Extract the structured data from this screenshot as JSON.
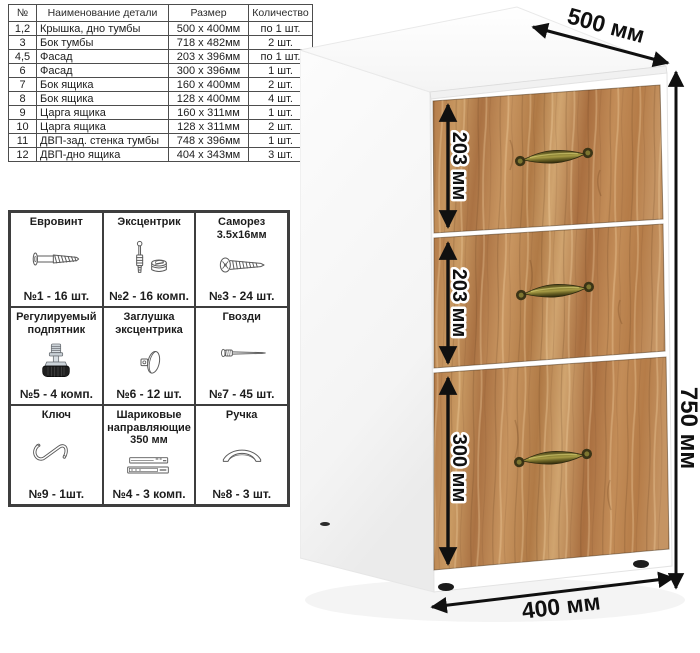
{
  "parts_table": {
    "headers": [
      "№",
      "Наименование детали",
      "Размер",
      "Количество"
    ],
    "rows": [
      {
        "num": "1,2",
        "name": "Крышка, дно тумбы",
        "size": "500 x 400мм",
        "qty": "по 1 шт."
      },
      {
        "num": "3",
        "name": "Бок тумбы",
        "size": "718 x 482мм",
        "qty": "2 шт."
      },
      {
        "num": "4,5",
        "name": "Фасад",
        "size": "203 x 396мм",
        "qty": "по 1 шт."
      },
      {
        "num": "6",
        "name": "Фасад",
        "size": "300 x 396мм",
        "qty": "1 шт."
      },
      {
        "num": "7",
        "name": "Бок ящика",
        "size": "160 x 400мм",
        "qty": "2 шт."
      },
      {
        "num": "8",
        "name": "Бок ящика",
        "size": "128 x 400мм",
        "qty": "4 шт."
      },
      {
        "num": "9",
        "name": "Царга ящика",
        "size": "160 x 311мм",
        "qty": "1 шт."
      },
      {
        "num": "10",
        "name": "Царга ящика",
        "size": "128 x 311мм",
        "qty": "2 шт."
      },
      {
        "num": "11",
        "name": "ДВП-зад. стенка тумбы",
        "size": "748 x 396мм",
        "qty": "1 шт."
      },
      {
        "num": "12",
        "name": "ДВП-дно ящика",
        "size": "404 x 343мм",
        "qty": "3 шт."
      }
    ]
  },
  "hardware": {
    "items": [
      {
        "title": "Евровинт",
        "icon_name": "euro-screw-icon",
        "icon_ref": "#ic-euro-screw",
        "count": "№1 - 16 шт."
      },
      {
        "title": "Эксцентрик",
        "icon_name": "cam-bolt-icon",
        "icon_ref": "#ic-cam-bolt",
        "count": "№2 - 16 комп."
      },
      {
        "title": "Саморез 3.5х16мм",
        "icon_name": "self-tapping-screw-icon",
        "icon_ref": "#ic-screw",
        "count": "№3 - 24 шт."
      },
      {
        "title": "Регулируемый подпятник",
        "icon_name": "adjustable-foot-icon",
        "icon_ref": "#ic-foot",
        "count": "№5 - 4 комп."
      },
      {
        "title": "Заглушка эксцентрика",
        "icon_name": "cam-cap-icon",
        "icon_ref": "#ic-cap",
        "count": "№6 - 12 шт."
      },
      {
        "title": "Гвозди",
        "icon_name": "nail-icon",
        "icon_ref": "#ic-nail",
        "count": "№7 - 45 шт."
      },
      {
        "title": "Ключ",
        "icon_name": "hex-key-icon",
        "icon_ref": "#ic-key",
        "count": "№9 - 1шт."
      },
      {
        "title": "Шариковые направляющие 350 мм",
        "icon_name": "ball-bearing-slides-icon",
        "icon_ref": "#ic-slides",
        "count": "№4 - 3 комп."
      },
      {
        "title": "Ручка",
        "icon_name": "drawer-handle-icon",
        "icon_ref": "#ic-handle",
        "count": "№8 - 3 шт."
      }
    ]
  },
  "cabinet": {
    "depth_label": "500 мм",
    "height_label": "750 мм",
    "width_label": "400 мм",
    "drawer_labels": [
      "203 мм",
      "203 мм",
      "300 мм"
    ]
  },
  "colors": {
    "wood_base": "#b98050",
    "wood_light": "#d0a46f",
    "wood_dark": "#9a6a42",
    "handle_brass": "#8c8335",
    "dimension_text": "#101010",
    "table_border": "#4d4d4d"
  }
}
